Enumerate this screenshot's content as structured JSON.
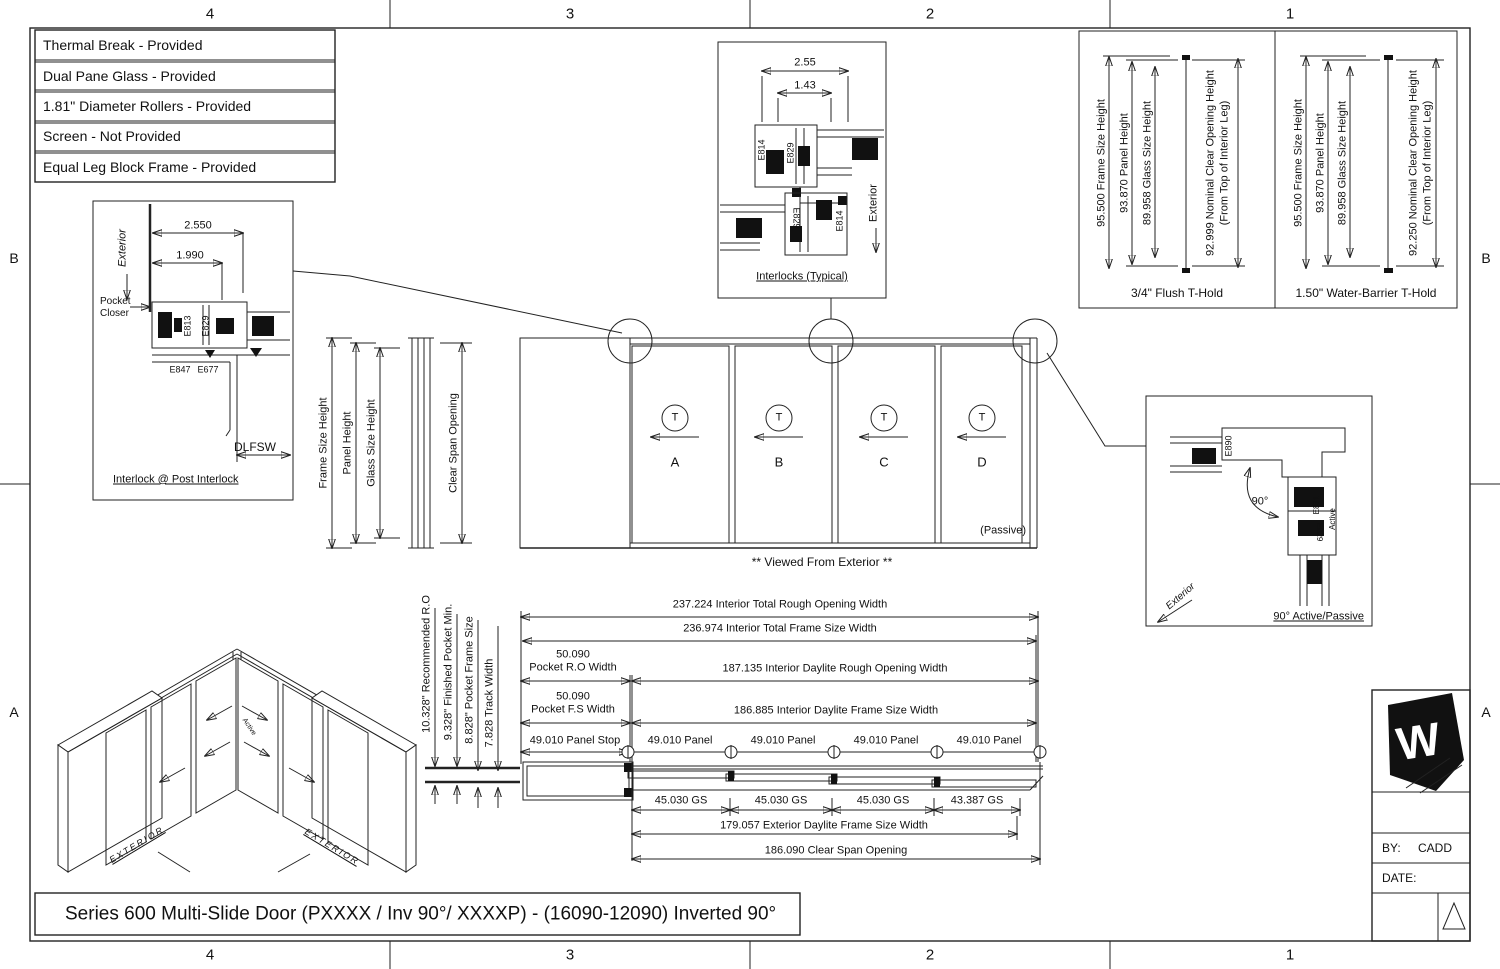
{
  "sheet": {
    "grid_top": [
      "4",
      "3",
      "2",
      "1"
    ],
    "grid_bottom": [
      "4",
      "3",
      "2",
      "1"
    ],
    "grid_left": [
      "B",
      "A"
    ],
    "grid_right": [
      "B",
      "A"
    ],
    "title": "Series 600 Multi-Slide Door (PXXXX / Inv 90°/ XXXXP) - (16090-12090) Inverted 90°",
    "by_label": "BY:",
    "by_value": "CADD",
    "date_label": "DATE:",
    "logo_letter": "W"
  },
  "features": [
    "Thermal Break - Provided",
    "Dual Pane Glass - Provided",
    "1.81\" Diameter Rollers - Provided",
    "Screen - Not Provided",
    "Equal Leg Block Frame - Provided"
  ],
  "post_interlock": {
    "exterior": "Exterior",
    "dim_a": "2.550",
    "dim_b": "1.990",
    "pocket_closer_1": "Pocket",
    "pocket_closer_2": "Closer",
    "part_e813": "E813",
    "part_e829": "E829",
    "part_e847": "E847",
    "part_e677": "E677",
    "dlfsw": "DLFSW",
    "caption": "Interlock @ Post Interlock"
  },
  "interlocks": {
    "dim_a": "2.55",
    "dim_b": "1.43",
    "part_e814_a": "E814",
    "part_e829_a": "E829",
    "part_e829_b": "E829",
    "part_e814_b": "E814",
    "exterior": "Exterior",
    "caption": "Interlocks (Typical)"
  },
  "flush_thold": {
    "frame": "95.500 Frame Size Height",
    "panel": "93.870 Panel Height",
    "glass": "89.958 Glass Size Height",
    "clear_1": "92.999 Nominal Clear Opening Height",
    "clear_2": "(From Top of Interior Leg)",
    "caption": "3/4\" Flush T-Hold"
  },
  "water_thold": {
    "frame": "95.500 Frame Size Height",
    "panel": "93.870 Panel Height",
    "glass": "89.958 Glass Size Height",
    "clear_1": "92.250 Nominal Clear Opening Height",
    "clear_2": "(From Top of Interior Leg)",
    "caption": "1.50\" Water-Barrier T-Hold"
  },
  "elevation": {
    "dim_frame": "Frame Size Height",
    "dim_panel": "Panel Height",
    "dim_glass": "Glass Size Height",
    "dim_clear": "Clear Span Opening",
    "panels": [
      {
        "tag": "T",
        "letter": "A"
      },
      {
        "tag": "T",
        "letter": "B"
      },
      {
        "tag": "T",
        "letter": "C"
      },
      {
        "tag": "T",
        "letter": "D"
      }
    ],
    "passive": "(Passive)",
    "caption": "** Viewed From Exterior **"
  },
  "corner_detail": {
    "part_e890": "E890",
    "part_e871": "E871",
    "part_e829": "E829",
    "angle": "90°",
    "active": "Active",
    "exterior": "Exterior",
    "caption": "90° Active/Passive"
  },
  "isometric": {
    "exterior_left": "EXTERIOR",
    "exterior_right": "EXTERIOR",
    "active": "Active"
  },
  "width_dims": {
    "pocket_labels": [
      "10.328\" Recommended R.O",
      "9.328\" Finished Pocket Min.",
      "8.828\" Pocket Frame Size",
      "7.828 Track Width"
    ],
    "total_ro": "237.224 Interior Total Rough Opening Width",
    "total_fs": "236.974 Interior Total Frame Size Width",
    "pocket_ro_val": "50.090",
    "pocket_ro_lbl": "Pocket R.O Width",
    "daylite_ro": "187.135 Interior Daylite Rough Opening Width",
    "pocket_fs_val": "50.090",
    "pocket_fs_lbl": "Pocket F.S Width",
    "daylite_fs": "186.885 Interior Daylite Frame Size Width",
    "panel_stop": "49.010 Panel Stop",
    "panels": [
      "49.010 Panel",
      "49.010 Panel",
      "49.010 Panel",
      "49.010 Panel"
    ],
    "gs": [
      "45.030 GS",
      "45.030 GS",
      "45.030 GS",
      "43.387 GS"
    ],
    "ext_daylite": "179.057 Exterior Daylite Frame Size Width",
    "clear_span": "186.090 Clear Span Opening"
  }
}
